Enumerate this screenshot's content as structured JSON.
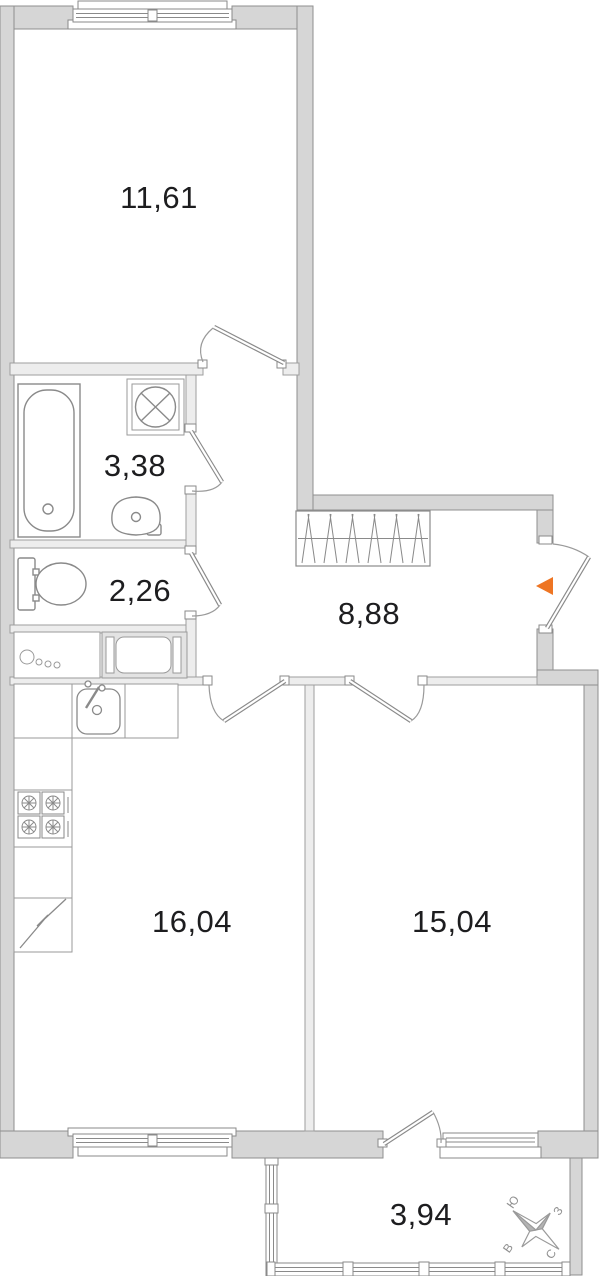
{
  "title": "Apartment floor plan",
  "rooms": {
    "top_room": {
      "label": "11,61"
    },
    "bathroom": {
      "label": "3,38"
    },
    "wc": {
      "label": "2,26"
    },
    "hallway": {
      "label": "8,88"
    },
    "kitchen": {
      "label": "16,04"
    },
    "room_right": {
      "label": "15,04"
    },
    "balcony": {
      "label": "3,94"
    }
  },
  "compass": {
    "north": "С",
    "south": "Ю",
    "west": "З",
    "east": "В"
  },
  "entrance_marker_color": "#ee7523",
  "colors": {
    "wall_fill": "#d6d6d6",
    "wall_stroke": "#8f8f8f",
    "partition_fill": "#ededed",
    "fixture_stroke": "#8a8a8a",
    "label_text": "#1d1d1f",
    "compass_gray": "#9a9a9a"
  }
}
